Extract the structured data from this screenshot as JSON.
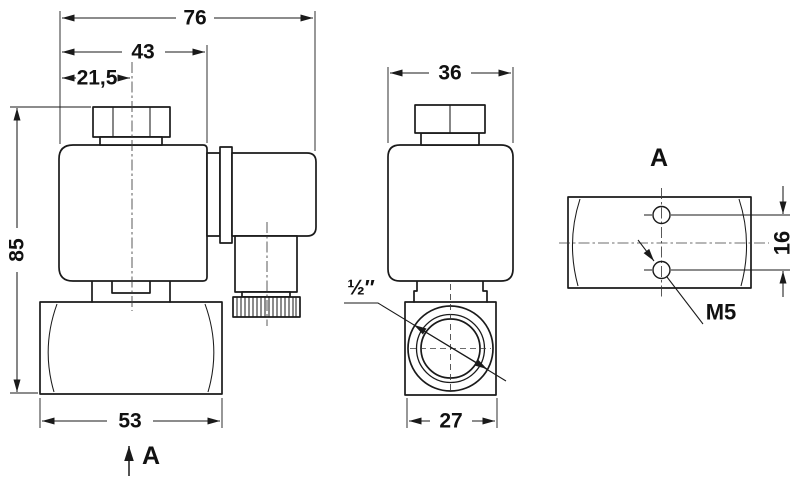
{
  "drawing": {
    "type": "technical-drawing",
    "subject": "solenoid valve three-view dimensional drawing",
    "background_color": "#ffffff",
    "line_color": "#1a1a1a",
    "views": {
      "side": {
        "dims": {
          "total_width": "76",
          "coil_width": "43",
          "center_offset": "21,5",
          "total_height": "85",
          "body_width": "53"
        },
        "section_arrow_label": "A"
      },
      "front": {
        "dims": {
          "coil_width": "36",
          "body_width": "27"
        },
        "port_thread": "½″"
      },
      "bottom": {
        "view_label": "A",
        "dims": {
          "hole_spacing": "16"
        },
        "hole_thread": "M5"
      }
    }
  }
}
